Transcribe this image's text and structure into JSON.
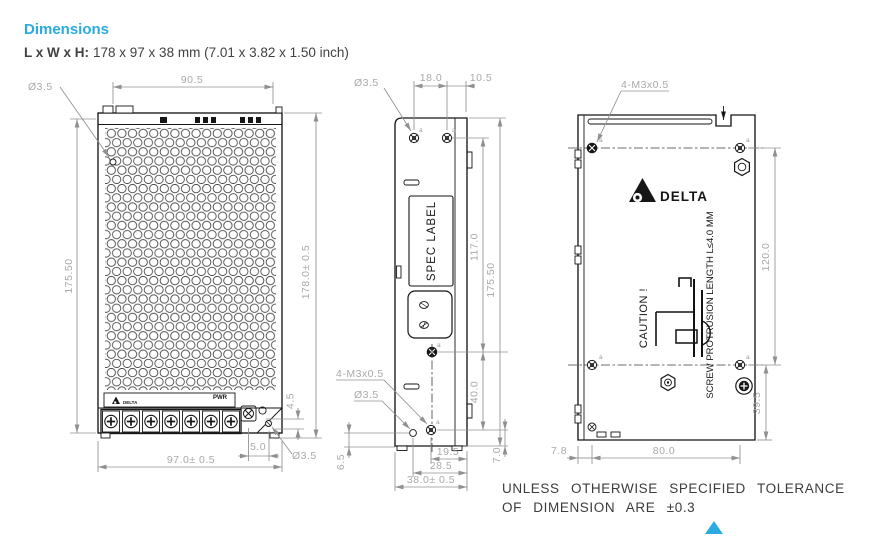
{
  "header": {
    "title": "Dimensions",
    "size_label": "L x W x H:",
    "size_value": "178 x 97 x 38 mm (7.01 x 3.82 x 1.50 inch)"
  },
  "front_view": {
    "dim_hole_top": "Ø3.5",
    "dim_top_width": "90.5",
    "dim_left_height": "175.50",
    "dim_right_height": "178.0± 0.5",
    "dim_corner_height": "4.5",
    "dim_pot_offset": "5.0",
    "dim_hole_bottom": "Ø3.5",
    "dim_bottom_width": "97.0± 0.5",
    "label_brand": "DELTA",
    "label_pwr": "PWR"
  },
  "side_view": {
    "dim_hole_top": "Ø3.5",
    "dim_screw_pitch": "18.0",
    "dim_edge_offset": "10.5",
    "dim_mid_height": "117.0",
    "dim_full_height": "175.50",
    "dim_lower_pitch": "40.0",
    "dim_bottom_offset": "7.0",
    "label_thread": "4-M3x0.5",
    "dim_hole_bottom": "Ø3.5",
    "dim_side_offset": "6.5",
    "dim_hole_to_edge": "19.5",
    "dim_hole_span": "28.5",
    "dim_bottom_width": "38.0± 0.5",
    "label_spec": "SPEC LABEL",
    "datum": "a"
  },
  "back_view": {
    "label_thread": "4-M3x0.5",
    "label_brand": "DELTA",
    "label_caution": "CAUTION !",
    "label_screw_note": "SCREW PROTRUSION LENGTH L≤4.0 MM",
    "dim_vertical_pitch": "120.0",
    "dim_bottom_offset": "39.5",
    "dim_left_offset": "7.8",
    "dim_horizontal_pitch": "80.0",
    "datum": "a"
  },
  "footer": {
    "tolerance_line1": "UNLESS OTHERWISE SPECIFIED TOLERANCE",
    "tolerance_line2": "OF DIMENSION ARE ±0.3"
  },
  "colors": {
    "accent": "#29abe2",
    "outline": "#161616",
    "dimension": "#a9a9a9"
  }
}
